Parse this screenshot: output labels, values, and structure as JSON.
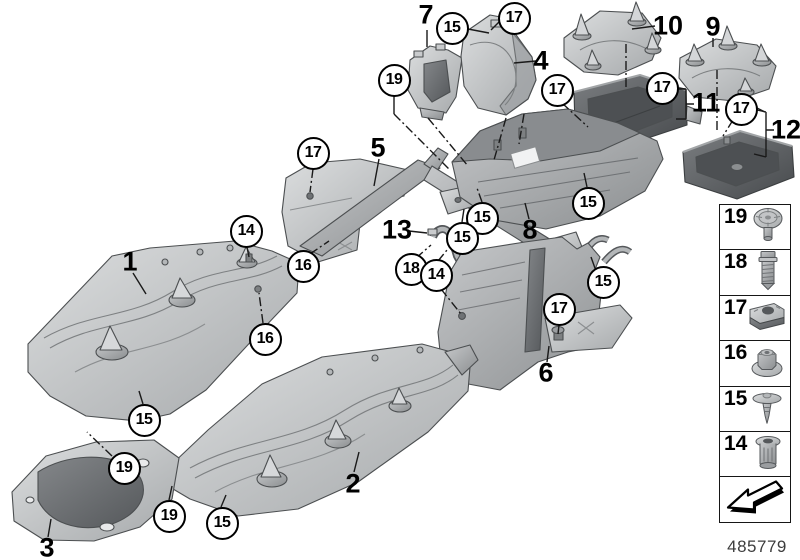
{
  "page": {
    "footer_number": "485779"
  },
  "colors": {
    "background": "#ffffff",
    "panel_light": "#d9dbdc",
    "panel_mid": "#a9acaf",
    "tray_dark": "#54575a",
    "outline": "#4c4f51",
    "callout_border": "#000000",
    "callout_bg": "#ffffff"
  },
  "diagram": {
    "part_labels": [
      {
        "id": "7",
        "x": 426,
        "y": 15
      },
      {
        "id": "4",
        "x": 541,
        "y": 61
      },
      {
        "id": "10",
        "x": 668,
        "y": 26
      },
      {
        "id": "9",
        "x": 713,
        "y": 27
      },
      {
        "id": "11",
        "x": 706,
        "y": 103
      },
      {
        "id": "12",
        "x": 786,
        "y": 130
      },
      {
        "id": "5",
        "x": 378,
        "y": 148
      },
      {
        "id": "13",
        "x": 397,
        "y": 230
      },
      {
        "id": "8",
        "x": 530,
        "y": 230
      },
      {
        "id": "1",
        "x": 130,
        "y": 262
      },
      {
        "id": "6",
        "x": 546,
        "y": 373
      },
      {
        "id": "2",
        "x": 353,
        "y": 484
      },
      {
        "id": "3",
        "x": 47,
        "y": 548
      }
    ],
    "callouts": [
      {
        "n": "15",
        "x": 452,
        "y": 28
      },
      {
        "n": "17",
        "x": 514,
        "y": 18
      },
      {
        "n": "19",
        "x": 394,
        "y": 80
      },
      {
        "n": "17",
        "x": 557,
        "y": 90
      },
      {
        "n": "17",
        "x": 662,
        "y": 88
      },
      {
        "n": "17",
        "x": 741,
        "y": 109
      },
      {
        "n": "17",
        "x": 313,
        "y": 153
      },
      {
        "n": "15",
        "x": 588,
        "y": 203
      },
      {
        "n": "15",
        "x": 482,
        "y": 218
      },
      {
        "n": "14",
        "x": 246,
        "y": 231
      },
      {
        "n": "15",
        "x": 462,
        "y": 238
      },
      {
        "n": "16",
        "x": 303,
        "y": 266
      },
      {
        "n": "18",
        "x": 411,
        "y": 269
      },
      {
        "n": "14",
        "x": 436,
        "y": 275
      },
      {
        "n": "15",
        "x": 603,
        "y": 282
      },
      {
        "n": "17",
        "x": 559,
        "y": 309
      },
      {
        "n": "16",
        "x": 265,
        "y": 339
      },
      {
        "n": "15",
        "x": 144,
        "y": 420
      },
      {
        "n": "19",
        "x": 124,
        "y": 468
      },
      {
        "n": "19",
        "x": 169,
        "y": 516
      },
      {
        "n": "15",
        "x": 222,
        "y": 523
      }
    ]
  },
  "legend": {
    "items": [
      {
        "number": "19",
        "icon": "flanged-rivet-icon"
      },
      {
        "number": "18",
        "icon": "hex-bolt-icon"
      },
      {
        "number": "17",
        "icon": "cage-nut-icon"
      },
      {
        "number": "16",
        "icon": "flange-nut-icon"
      },
      {
        "number": "15",
        "icon": "expanding-rivet-icon"
      },
      {
        "number": "14",
        "icon": "expansion-sleeve-icon"
      }
    ],
    "direction_box": {
      "icon": "direction-arrow-icon"
    }
  }
}
